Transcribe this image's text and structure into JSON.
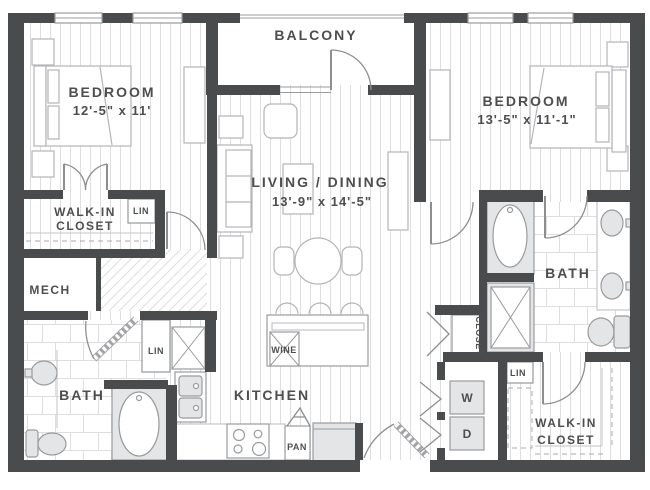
{
  "rooms": {
    "balcony": {
      "label": "BALCONY"
    },
    "bedroom_left": {
      "label": "BEDROOM",
      "dims": "12'-5\" x 11'"
    },
    "bedroom_right": {
      "label": "BEDROOM",
      "dims": "13'-5\" x 11'-1\""
    },
    "living_dining": {
      "label": "LIVING / DINING",
      "dims": "13'-9\" x 14'-5\""
    },
    "walk_in_closet_left": {
      "line1": "WALK-IN",
      "line2": "CLOSET"
    },
    "walk_in_closet_right": {
      "line1": "WALK-IN",
      "line2": "CLOSET"
    },
    "mech": {
      "label": "MECH"
    },
    "bath_left": {
      "label": "BATH"
    },
    "bath_right": {
      "label": "BATH"
    },
    "kitchen": {
      "label": "KITCHEN"
    },
    "closet": {
      "label": "CLOSET"
    }
  },
  "features": {
    "lin_bedroom_closet": "LIN",
    "lin_hall": "LIN",
    "lin_laundry": "LIN",
    "wine_cooler": "WINE",
    "pantry": "PAN",
    "washer": "W",
    "dryer": "D"
  },
  "colors": {
    "wall": "#4a4b4d",
    "text": "#4d4e50",
    "fixture": "#e4e5e6",
    "line": "#97989b",
    "floor": "#dedede"
  }
}
